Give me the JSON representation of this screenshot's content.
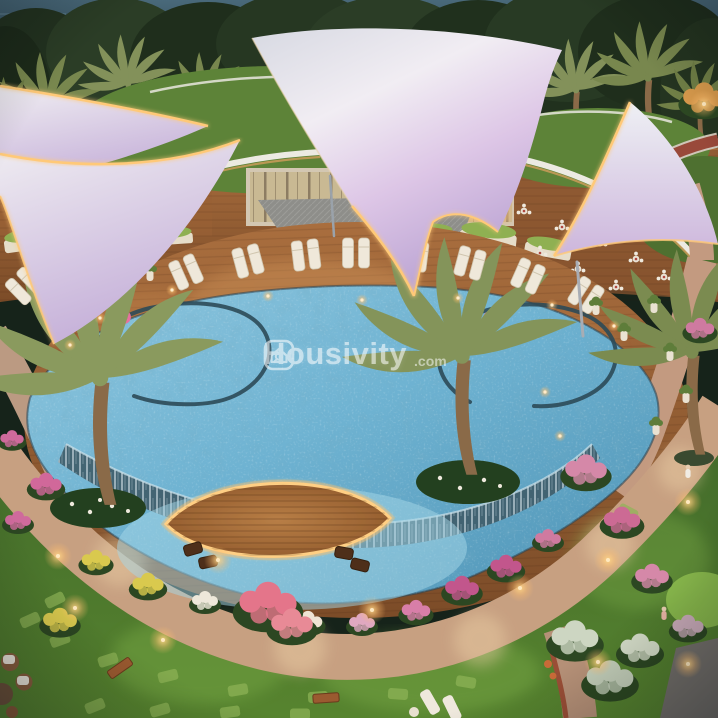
{
  "watermark": {
    "icon": "house-magnifier-icon",
    "brand": "Housivity",
    "suffix": ".com"
  },
  "palette": {
    "sky_water": "#3d5a66",
    "trees": "#24341f",
    "palm_olive": "#7d8c52",
    "roof_lawn": "#5d8338",
    "lawn": "#4a7a2c",
    "lawn_lit": "#7fae4a",
    "canopy_light": "#efecf2",
    "canopy_lavender": "#c3a8d8",
    "gold_light": "#ffc978",
    "deck_wood": "#96613a",
    "deck_lit": "#c98a50",
    "pool_blue": "#6fb3d2",
    "pool_deep": "#4d92b4",
    "pool_shallow": "#a7d8e8",
    "waterfall": "#40606e",
    "path_tan": "#c7a081",
    "flower_pink": "#d987a8",
    "flower_magenta": "#c2568c",
    "flower_yellow": "#d9c94e",
    "flower_red": "#e4758a",
    "planter_white": "#eae2d2",
    "track_red": "#99493a",
    "building_wall": "#d3c7b2",
    "glass_warm": "#e8b678"
  }
}
